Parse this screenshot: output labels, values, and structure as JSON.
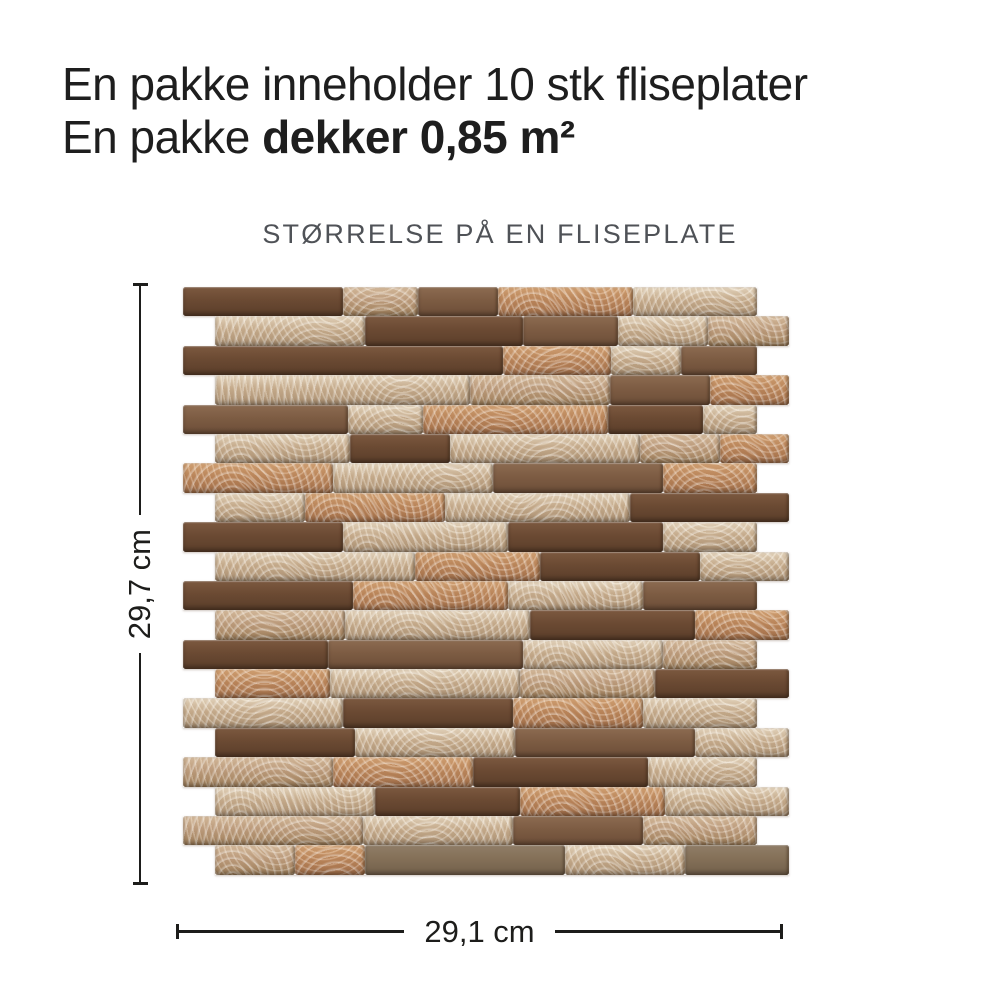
{
  "header": {
    "line1": "En pakke inneholder 10 stk fliseplater",
    "line2_regular": "En pakke ",
    "line2_bold": "dekker 0,85 m²"
  },
  "section": {
    "title": "STØRRELSE PÅ EN FLISEPLATE"
  },
  "dimensions": {
    "height_label": "29,7 cm",
    "width_label": "29,1 cm"
  },
  "colors": {
    "text": "#1e1e1e",
    "heading": "#4f5257",
    "line": "#1d1d1b",
    "background": "#ffffff",
    "finishes": {
      "dark": {
        "base": "#6b4a33",
        "hi": "#7c5940",
        "lo": "#5b3e2a",
        "brushed": false
      },
      "brown": {
        "base": "#7d5c43",
        "hi": "#8c6b51",
        "lo": "#6c4e38",
        "brushed": false
      },
      "graybrown": {
        "base": "#847058",
        "hi": "#907d67",
        "lo": "#72604b",
        "brushed": false
      },
      "silver": {
        "base": "#ccb394",
        "hi": "#eee1cb",
        "lo": "#ae9578",
        "brushed": true
      },
      "tan": {
        "base": "#c2a283",
        "hi": "#ddc4a6",
        "lo": "#a3845f",
        "brushed": true
      },
      "copper": {
        "base": "#c08a5e",
        "hi": "#daa97a",
        "lo": "#a5714c",
        "brushed": true
      }
    }
  },
  "tile": {
    "row_height": 29.4,
    "unit_width": 574,
    "rows": [
      {
        "offset": 0,
        "segments": [
          {
            "finish": "dark",
            "w": 160
          },
          {
            "finish": "tan",
            "w": 75
          },
          {
            "finish": "brown",
            "w": 80
          },
          {
            "finish": "copper",
            "w": 135
          },
          {
            "finish": "silver",
            "w": 124
          }
        ]
      },
      {
        "offset": 32,
        "segments": [
          {
            "finish": "silver",
            "w": 150
          },
          {
            "finish": "dark",
            "w": 158
          },
          {
            "finish": "brown",
            "w": 95
          },
          {
            "finish": "silver",
            "w": 90
          },
          {
            "finish": "tan",
            "w": 81
          }
        ]
      },
      {
        "offset": 0,
        "segments": [
          {
            "finish": "dark",
            "w": 320
          },
          {
            "finish": "copper",
            "w": 108
          },
          {
            "finish": "silver",
            "w": 70
          },
          {
            "finish": "brown",
            "w": 76
          }
        ]
      },
      {
        "offset": 32,
        "segments": [
          {
            "finish": "silver",
            "w": 255
          },
          {
            "finish": "tan",
            "w": 140
          },
          {
            "finish": "brown",
            "w": 100
          },
          {
            "finish": "copper",
            "w": 79
          }
        ]
      },
      {
        "offset": 0,
        "segments": [
          {
            "finish": "brown",
            "w": 165
          },
          {
            "finish": "silver",
            "w": 75
          },
          {
            "finish": "copper",
            "w": 185
          },
          {
            "finish": "dark",
            "w": 95
          },
          {
            "finish": "silver",
            "w": 54
          }
        ]
      },
      {
        "offset": 32,
        "segments": [
          {
            "finish": "silver",
            "w": 135
          },
          {
            "finish": "dark",
            "w": 100
          },
          {
            "finish": "silver",
            "w": 190
          },
          {
            "finish": "tan",
            "w": 80
          },
          {
            "finish": "copper",
            "w": 69
          }
        ]
      },
      {
        "offset": 0,
        "segments": [
          {
            "finish": "copper",
            "w": 150
          },
          {
            "finish": "silver",
            "w": 160
          },
          {
            "finish": "brown",
            "w": 170
          },
          {
            "finish": "copper",
            "w": 94
          }
        ]
      },
      {
        "offset": 32,
        "segments": [
          {
            "finish": "silver",
            "w": 90
          },
          {
            "finish": "copper",
            "w": 140
          },
          {
            "finish": "silver",
            "w": 185
          },
          {
            "finish": "dark",
            "w": 159
          }
        ]
      },
      {
        "offset": 0,
        "segments": [
          {
            "finish": "dark",
            "w": 160
          },
          {
            "finish": "silver",
            "w": 165
          },
          {
            "finish": "dark",
            "w": 155
          },
          {
            "finish": "silver",
            "w": 94
          }
        ]
      },
      {
        "offset": 32,
        "segments": [
          {
            "finish": "silver",
            "w": 200
          },
          {
            "finish": "copper",
            "w": 125
          },
          {
            "finish": "dark",
            "w": 160
          },
          {
            "finish": "silver",
            "w": 89
          }
        ]
      },
      {
        "offset": 0,
        "segments": [
          {
            "finish": "dark",
            "w": 170
          },
          {
            "finish": "copper",
            "w": 155
          },
          {
            "finish": "silver",
            "w": 135
          },
          {
            "finish": "brown",
            "w": 114
          }
        ]
      },
      {
        "offset": 32,
        "segments": [
          {
            "finish": "tan",
            "w": 130
          },
          {
            "finish": "silver",
            "w": 185
          },
          {
            "finish": "dark",
            "w": 165
          },
          {
            "finish": "copper",
            "w": 94
          }
        ]
      },
      {
        "offset": 0,
        "segments": [
          {
            "finish": "dark",
            "w": 145
          },
          {
            "finish": "brown",
            "w": 195
          },
          {
            "finish": "silver",
            "w": 140
          },
          {
            "finish": "tan",
            "w": 94
          }
        ]
      },
      {
        "offset": 32,
        "segments": [
          {
            "finish": "copper",
            "w": 115
          },
          {
            "finish": "silver",
            "w": 190
          },
          {
            "finish": "tan",
            "w": 135
          },
          {
            "finish": "dark",
            "w": 134
          }
        ]
      },
      {
        "offset": 0,
        "segments": [
          {
            "finish": "silver",
            "w": 160
          },
          {
            "finish": "dark",
            "w": 170
          },
          {
            "finish": "copper",
            "w": 130
          },
          {
            "finish": "silver",
            "w": 114
          }
        ]
      },
      {
        "offset": 32,
        "segments": [
          {
            "finish": "dark",
            "w": 140
          },
          {
            "finish": "silver",
            "w": 160
          },
          {
            "finish": "brown",
            "w": 180
          },
          {
            "finish": "silver",
            "w": 94
          }
        ]
      },
      {
        "offset": 0,
        "segments": [
          {
            "finish": "tan",
            "w": 150
          },
          {
            "finish": "copper",
            "w": 140
          },
          {
            "finish": "dark",
            "w": 175
          },
          {
            "finish": "silver",
            "w": 109
          }
        ]
      },
      {
        "offset": 32,
        "segments": [
          {
            "finish": "silver",
            "w": 160
          },
          {
            "finish": "dark",
            "w": 145
          },
          {
            "finish": "copper",
            "w": 145
          },
          {
            "finish": "silver",
            "w": 124
          }
        ]
      },
      {
        "offset": 0,
        "segments": [
          {
            "finish": "tan",
            "w": 180
          },
          {
            "finish": "silver",
            "w": 150
          },
          {
            "finish": "brown",
            "w": 130
          },
          {
            "finish": "tan",
            "w": 114
          }
        ]
      },
      {
        "offset": 32,
        "segments": [
          {
            "finish": "tan",
            "w": 80
          },
          {
            "finish": "copper",
            "w": 70
          },
          {
            "finish": "graybrown",
            "w": 200
          },
          {
            "finish": "silver",
            "w": 120
          },
          {
            "finish": "graybrown",
            "w": 104
          }
        ]
      }
    ]
  }
}
